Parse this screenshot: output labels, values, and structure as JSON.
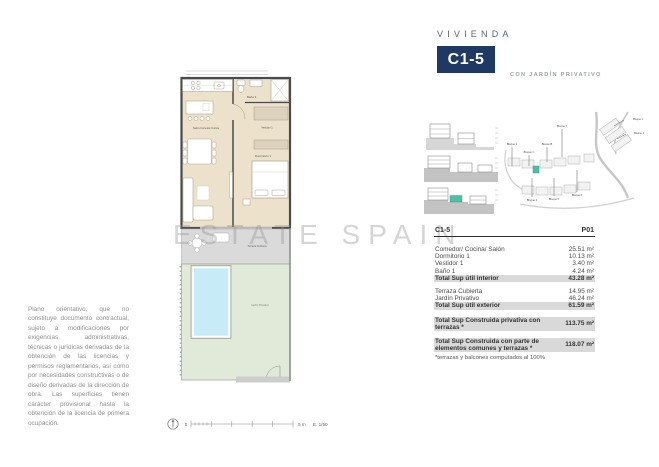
{
  "header": {
    "label": "VIVIENDA",
    "unit": "C1-5",
    "subtitle": "CON JARDÍN PRIVATIVO",
    "accent_color": "#1f3864"
  },
  "watermark": "ESTATE SPAIN",
  "floorplan": {
    "labels": {
      "living": "Salón-Comedor-Cocina",
      "bath": "Baño 1",
      "dressing": "Vestidor 1",
      "bedroom": "Dormitorio 1",
      "terrace": "Terraza Cubierta",
      "garden": "Jardín Privativo"
    },
    "colors": {
      "interior": "#ece1cb",
      "terrace": "#dadada",
      "garden": "#e1e9d8",
      "pool": "#c7ecf8",
      "wall": "#4a4a4a",
      "highlight_teal": "#4cc0a5"
    }
  },
  "siteplan": {
    "labels": [
      "Bloque 3",
      "Bloque C",
      "Bloque B",
      "Bloque 7",
      "Bloque 4",
      "Bloque 5",
      "Bloque 6",
      "Bloque 1",
      "Bloque 2"
    ]
  },
  "table": {
    "unit": "C1-5",
    "column": "P01",
    "rows": [
      {
        "label": "Comedor/ Cocina/ Salón",
        "value": "25.51 m²"
      },
      {
        "label": "Dormitorio 1",
        "value": "10.13 m²"
      },
      {
        "label": "Vestidor 1",
        "value": "3.40 m²"
      },
      {
        "label": "Baño 1",
        "value": "4.24 m²"
      },
      {
        "label": "Total Sup útil interior",
        "value": "43.28 m²"
      },
      {
        "label": "Terraza Cubierta",
        "value": "14.95 m²"
      },
      {
        "label": "Jardín Privativo",
        "value": "46.24 m²"
      },
      {
        "label": "Total Sup útil exterior",
        "value": "61.59 m²"
      },
      {
        "label": "Total Sup Construida privativa con terrazas *",
        "value": "113.75 m²"
      },
      {
        "label": "Total Sup Construida con parte de elementos comunes y terrazas *",
        "value": "118.07 m²"
      }
    ],
    "footnote": "*terrazas y balcones computados al 100%"
  },
  "disclaimer": "Plano orientativo, que no constituye documento contractual, sujeto a modificaciones por exigencias administrativas, técnicas o jurídicas derivadas de la obtención de las licencias y permisos reglamentarios, así como por necesidades constructivas o de diseño derivadas de la dirección de obra. Las superficies tienen carácter provisional hasta la obtención de la licencia de primera ocupación.",
  "scalebar": {
    "zero": "0",
    "length": "5 m",
    "scale": "E. 1/50"
  }
}
